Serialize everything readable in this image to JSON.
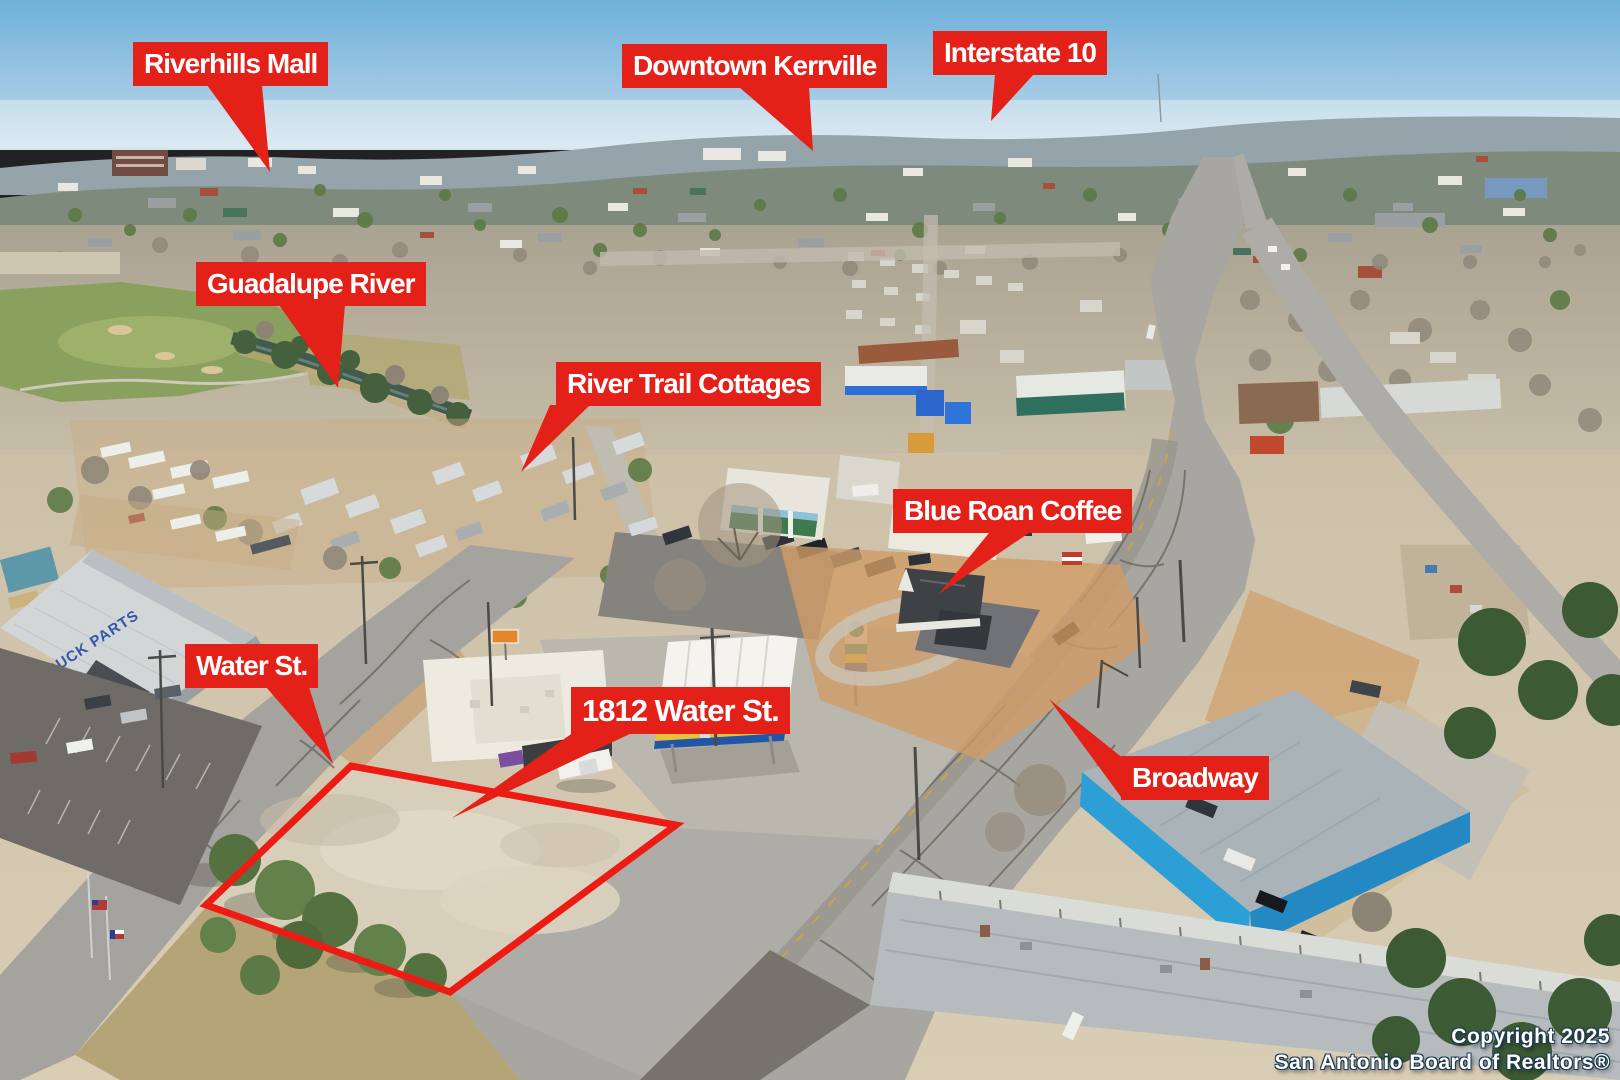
{
  "colors": {
    "label_bg": "#e32119",
    "label_text": "#ffffff",
    "parcel_outline": "#ec1c15",
    "copyright_text": "#ffffff",
    "store_sign_text": "#3358a8"
  },
  "callouts": {
    "riverhills_mall": "Riverhills Mall",
    "downtown_kerrville": "Downtown Kerrville",
    "interstate_10": "Interstate 10",
    "guadalupe_river": "Guadalupe River",
    "river_trail_cottages": "River Trail Cottages",
    "blue_roan_coffee": "Blue Roan Coffee",
    "water_st": "Water St.",
    "address_1812": "1812 Water St.",
    "broadway": "Broadway"
  },
  "scene_text": {
    "store_sign": "TO & TRUCK PARTS"
  },
  "copyright": {
    "line1": "Copyright 2025",
    "line2": "San Antonio Board of Realtors®"
  }
}
